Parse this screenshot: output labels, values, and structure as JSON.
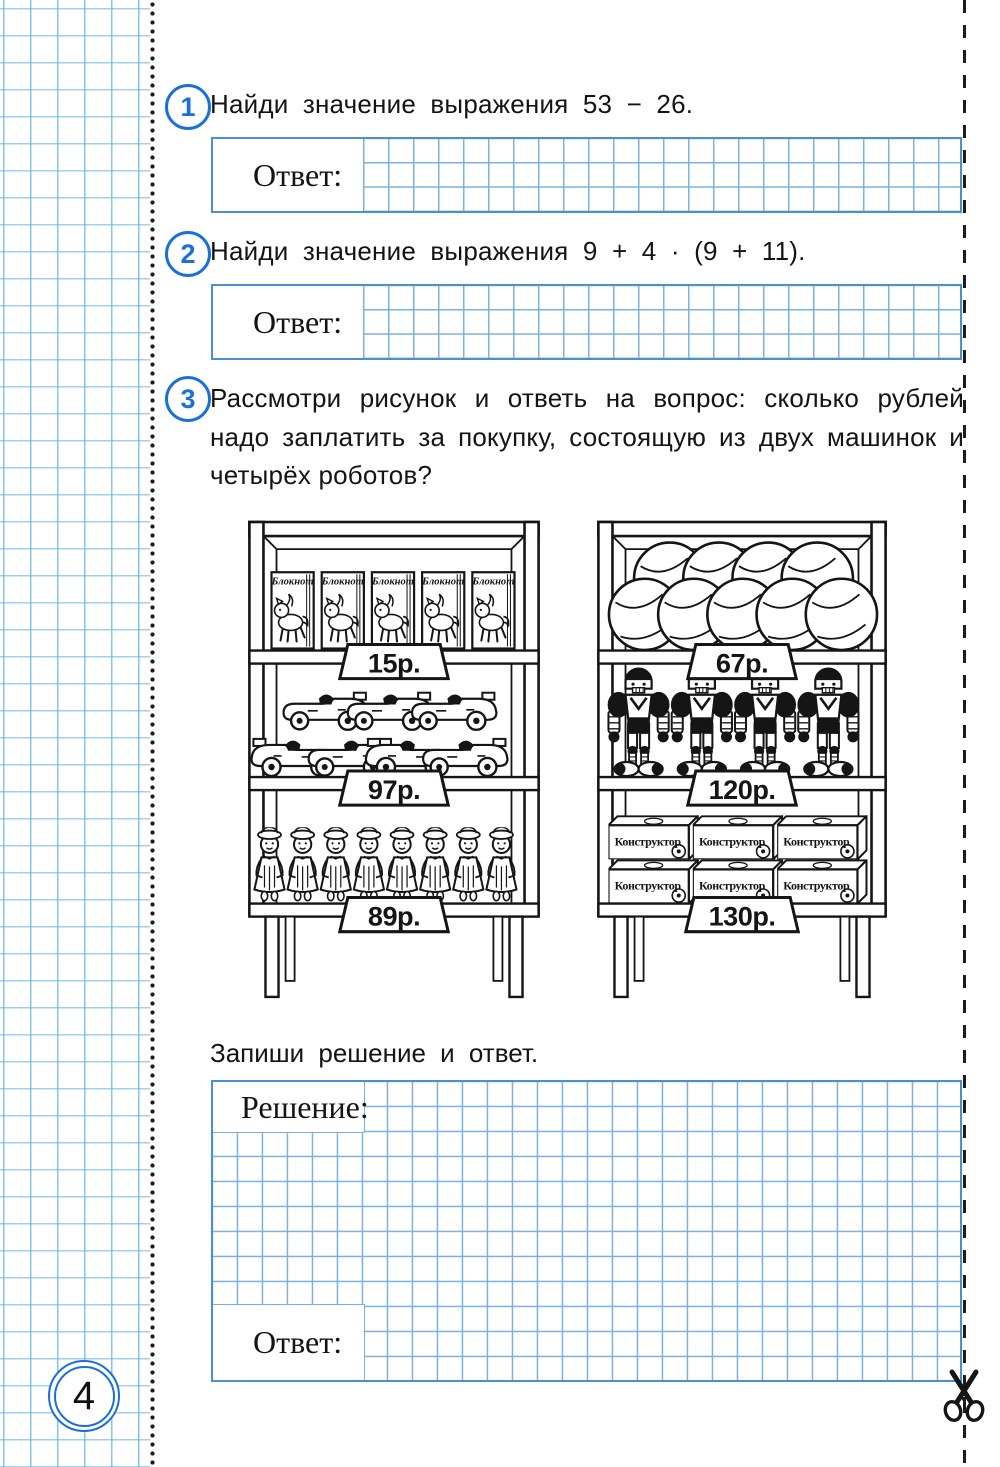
{
  "colors": {
    "accent_blue": "#1b6fdd",
    "grid_blue": "#7cb0e0",
    "margin_grid_blue": "#60b0e4",
    "ink": "#141414"
  },
  "tasks": {
    "t1": {
      "number": "1",
      "text": "Найди значение выражения 53 − 26.",
      "answer_label": "Ответ:"
    },
    "t2": {
      "number": "2",
      "text": "Найди значение выражения 9 + 4 · (9 + 11).",
      "answer_label": "Ответ:"
    },
    "t3": {
      "number": "3",
      "line1": "Рассмотри рисунок и ответь на вопрос: сколько рублей",
      "line2": "надо заплатить за покупку, состоящую из двух машинок и",
      "line3": "четырёх роботов?",
      "instruction": "Запиши решение и ответ.",
      "solution_label": "Решение:",
      "answer_label": "Ответ:"
    }
  },
  "figure": {
    "left_shelf": {
      "notebook_label": "Блокнот",
      "top_price": "15р.",
      "middle_price": "97р.",
      "bottom_price": "89р."
    },
    "right_shelf": {
      "box_label": "Конструктор",
      "top_price": "67р.",
      "middle_price": "120р.",
      "bottom_price": "130р."
    }
  },
  "footer": {
    "page_number": "4"
  }
}
